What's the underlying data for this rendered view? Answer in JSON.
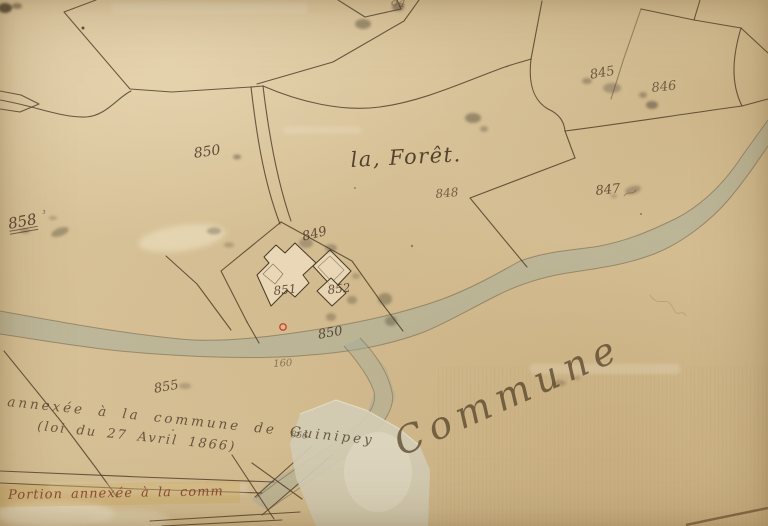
{
  "labels": {
    "place": "la, Forêt.",
    "commune": "Commune",
    "annex_line1": "annexée à la commune de Guinipey",
    "annex_line2": "(loi du 27 Avril 1866)",
    "portion": "Portion annexée à la comm",
    "parcels": {
      "n845": "845",
      "n846": "846",
      "n847": "847",
      "n848": "848",
      "n849": "849",
      "n850a": "850",
      "n850b": "850",
      "n851": "851",
      "n852": "852",
      "n855": "855",
      "n856": "856",
      "n858": "858",
      "n858_sup": "³",
      "n160": "160",
      "n84_top": "84"
    }
  },
  "colors": {
    "parchment": "#d8c298",
    "ink": "#4a3826",
    "stream_fill": "#a3ae9b",
    "red_ink": "#8a4431",
    "marker_red": "#c2492f",
    "patch": "#d3ccb4"
  }
}
